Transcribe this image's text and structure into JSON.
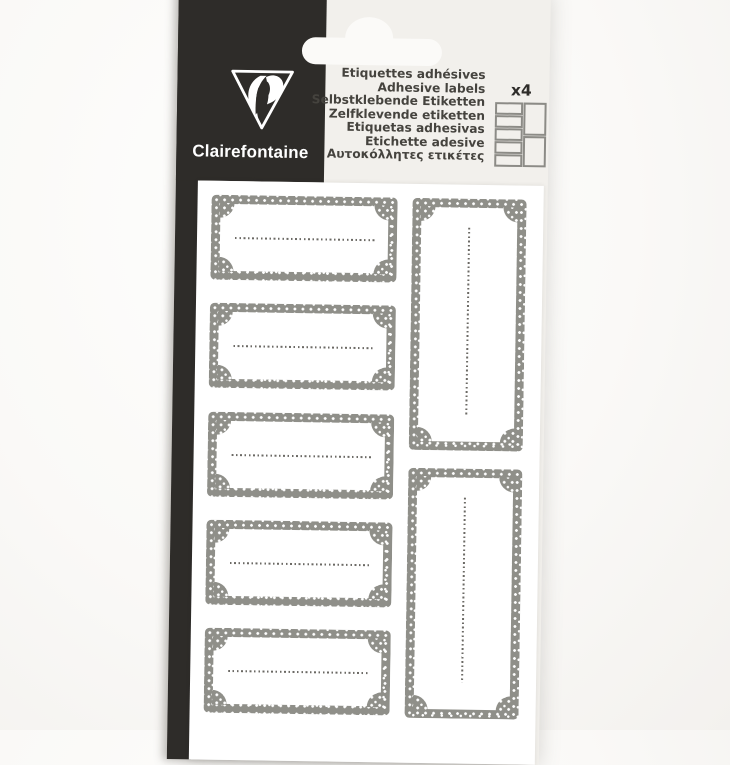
{
  "brand": {
    "name": "Clairefontaine"
  },
  "header": {
    "languages": [
      "Etiquettes adhésives",
      "Adhesive labels",
      "Selbstklebende Etiketten",
      "Zelfklevende etiketten",
      "Etiquetas adhesivas",
      "Etichette adesive",
      "Αυτοκόλλητες ετικέτες"
    ],
    "count_badge": "x4"
  },
  "sheet": {
    "small_labels": 5,
    "tall_labels": 2,
    "label_style": "grey polka-dot frame, blank interior with dotted writing line"
  },
  "colors": {
    "brand_black": "#2e2c29",
    "package_offwhite": "#f2f0ec",
    "sheet_white": "#ffffff",
    "label_border_grey": "#8f8f89",
    "dotted_line_grey": "#6b6964",
    "text_dark": "#45433e"
  }
}
